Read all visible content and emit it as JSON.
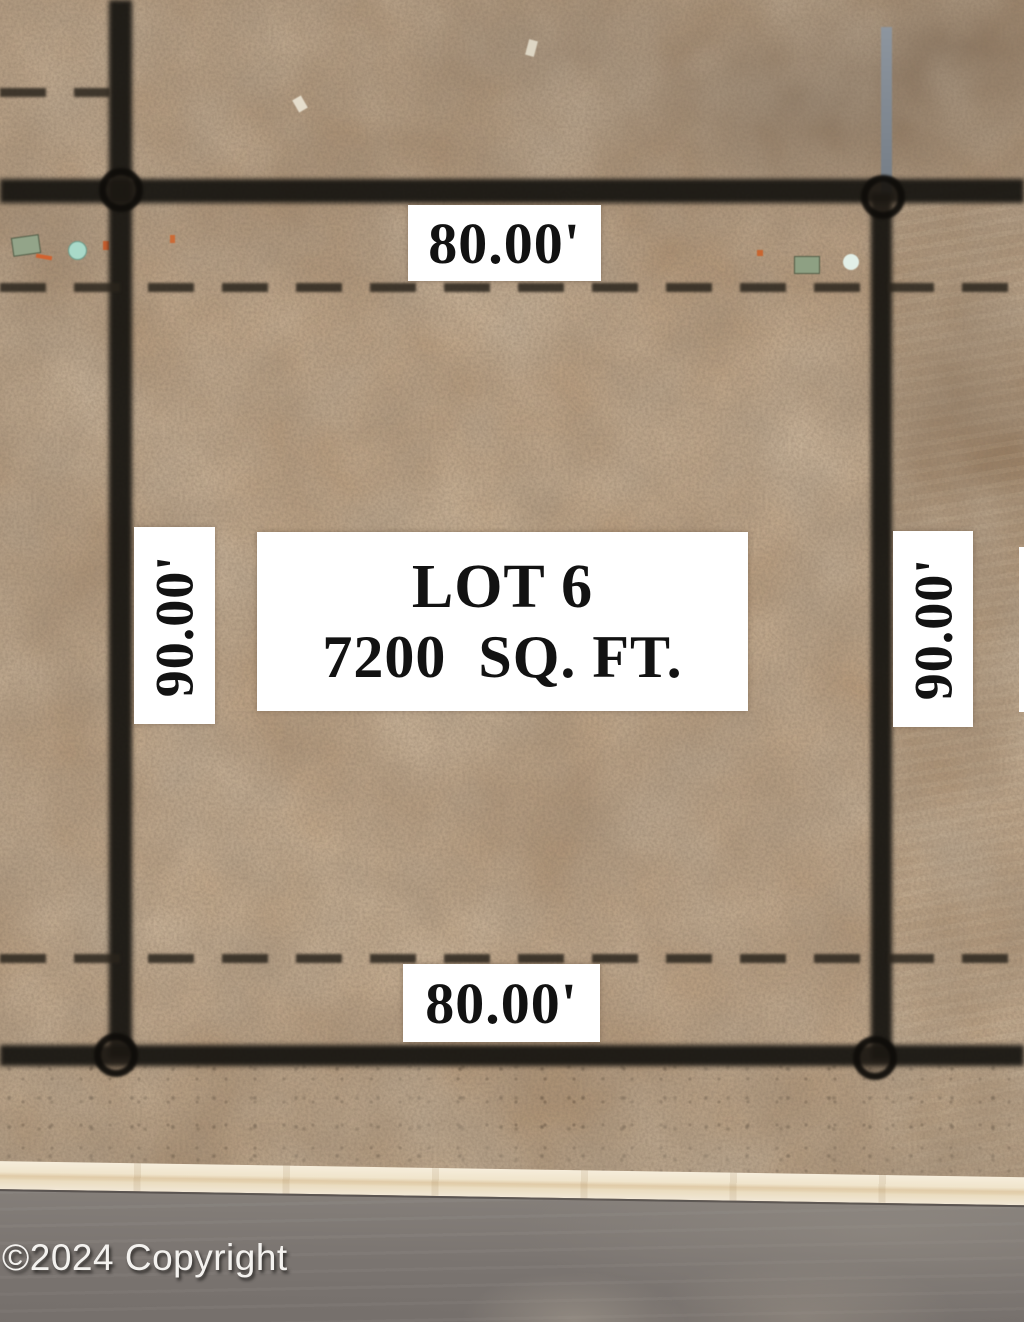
{
  "plat": {
    "lot": {
      "name": "LOT 6",
      "area": "7200  SQ. FT."
    },
    "dimensions": {
      "top": "80.00'",
      "bottom": "80.00'",
      "left": "90.00'",
      "right": "90.00'"
    }
  },
  "watermark": {
    "text": "©2024 Copyright"
  },
  "colors": {
    "dirt_base": "#b39677",
    "survey_line": "#14120f",
    "label_background": "#ffffff",
    "label_text": "#121212",
    "road_asphalt": "#7a7470",
    "curb_concrete": "#efe6d3",
    "utility_pole_gray": "#858d96",
    "watermark_text": "#f4f2ef"
  }
}
